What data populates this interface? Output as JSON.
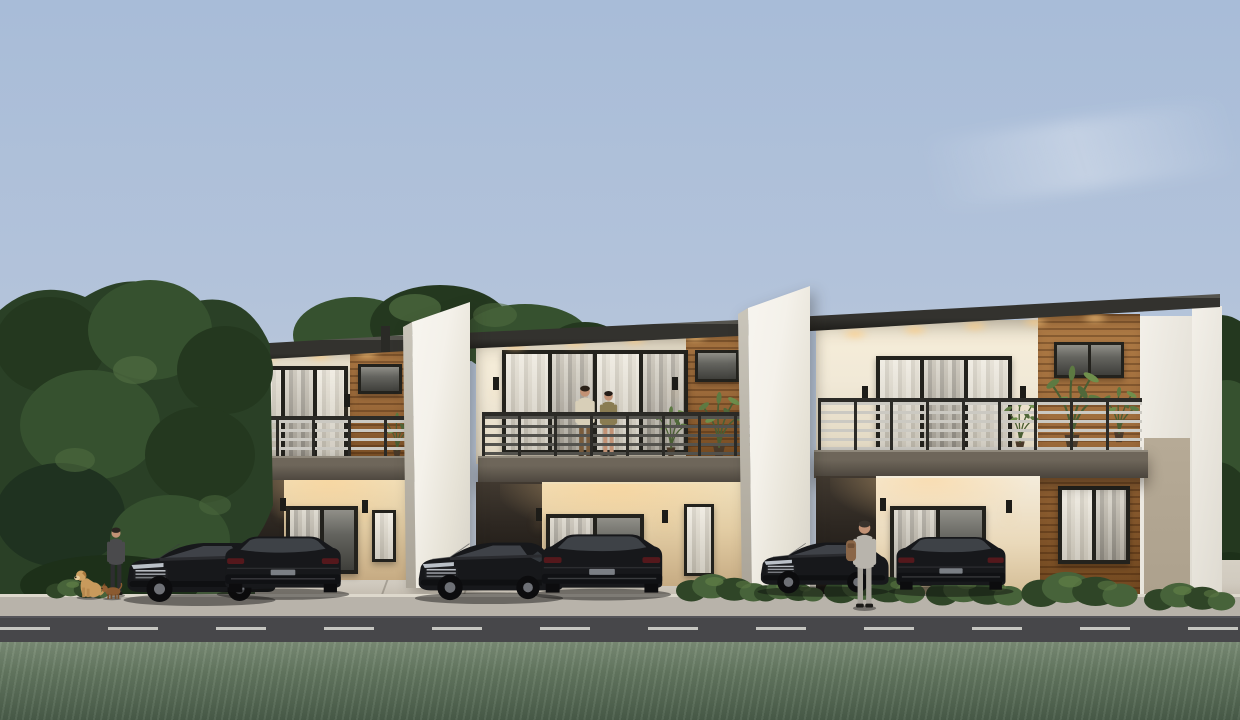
{
  "meta": {
    "description": "Architectural 3D exterior rendering at dusk: a row of three modern two-storey townhouses with cream walls, wood-slat accent panels, dark flat roofs, lit balconies with horizontal railings, six black parked cars, a couple standing on the middle balcony, a man with two dogs on the left, a person with a backpack walking in, shrubs, a road with dashed centerline and a grass lawn in the foreground."
  },
  "colors": {
    "sky_top": "#a8bcd8",
    "sky_horizon": "#c9d1dc",
    "tree_dark": "#24381f",
    "tree_mid": "#36512f",
    "tree_light": "#4e6b40",
    "grass_top": "#7c8e77",
    "grass_bottom": "#4a5d4a",
    "verge": "#3f5537",
    "road": "#47474a",
    "road_line": "#dddcd6",
    "sidewalk": "#b8b3aa",
    "concrete": "#d0cabf",
    "roof": "#33322e",
    "roof_edge": "#9b9a95",
    "wall_cream": "#f1e9d7",
    "wall_cream_dark": "#e0d6c0",
    "wall_warm": "#f0dfba",
    "wall_warm_deep": "#c6ab83",
    "recess_dark": "#2e2822",
    "wood": "#9c6a3a",
    "wood_dark": "#70471f",
    "slab_light": "#6e665a",
    "slab_dark": "#4a443c",
    "frame": "#23221d",
    "glass": "#64645f",
    "glass_dark": "#3f3f3b",
    "curtain": "#e3ded4",
    "fin": "#f4f1ea",
    "fin_shade": "#d4d0c6",
    "rail_light": "#cbc9c2",
    "rail_dark": "#54534e",
    "post": "#2c2b27",
    "shrub": "#47633a",
    "shrub_dark": "#2f4527",
    "car_body": "#17181b",
    "car_glass": "#43474c",
    "wheel": "#0c0c0e",
    "rim": "#6e7076",
    "chrome": "#b8bcc2",
    "glow": "#ffc98d",
    "skin": "#c29275",
    "taupe_wall": "#aca08c"
  },
  "scene": {
    "environment": {
      "sky": "clear dusk sky with faint cloud streak",
      "background": "dense trees on the left and behind the roofline, trees at far right",
      "foreground": "grass lawn, asphalt road with dashed white centerline, sidewalk, concrete driveways"
    },
    "units": [
      {
        "id": "unit-1",
        "label": "Townhouse unit 1 (left): two-storey, balcony with railing, wood accent panel, lit sconces, carport"
      },
      {
        "id": "unit-2",
        "label": "Townhouse unit 2 (middle): two-storey, couple standing on balcony, wood accent panel, potted plants"
      },
      {
        "id": "unit-3",
        "label": "Townhouse unit 3 (right): two-storey, full-height wood accent column, balcony plants, taupe side wall"
      }
    ],
    "dividers": [
      {
        "id": "fin-1",
        "label": "White divider fin wall between units 1 and 2"
      },
      {
        "id": "fin-2",
        "label": "White divider fin wall between units 2 and 3"
      }
    ],
    "vehicles": [
      {
        "id": "car-1",
        "label": "Black SUV, unit 1 driveway, front three-quarter view"
      },
      {
        "id": "car-2",
        "label": "Black crossover, unit 1 driveway, rear view"
      },
      {
        "id": "car-3",
        "label": "Black SUV, unit 2 driveway, front three-quarter view"
      },
      {
        "id": "car-4",
        "label": "Black crossover, unit 2 driveway, rear view"
      },
      {
        "id": "car-5",
        "label": "Black SUV, unit 3 driveway, front three-quarter view"
      },
      {
        "id": "car-6",
        "label": "Black crossover, unit 3 driveway, rear view"
      }
    ],
    "people": [
      {
        "id": "man-with-dogs",
        "label": "Man in dark clothes standing on the left lawn"
      },
      {
        "id": "balcony-man",
        "label": "Man in light jacket on middle balcony"
      },
      {
        "id": "balcony-woman",
        "label": "Woman in olive dress on middle balcony"
      },
      {
        "id": "walking-person",
        "label": "Person with brown backpack walking between cars at unit 3"
      }
    ],
    "animals": [
      {
        "id": "dog-golden",
        "label": "Golden retriever sitting on the lawn"
      },
      {
        "id": "dog-small",
        "label": "Small brown dog beside the golden retriever"
      }
    ]
  }
}
